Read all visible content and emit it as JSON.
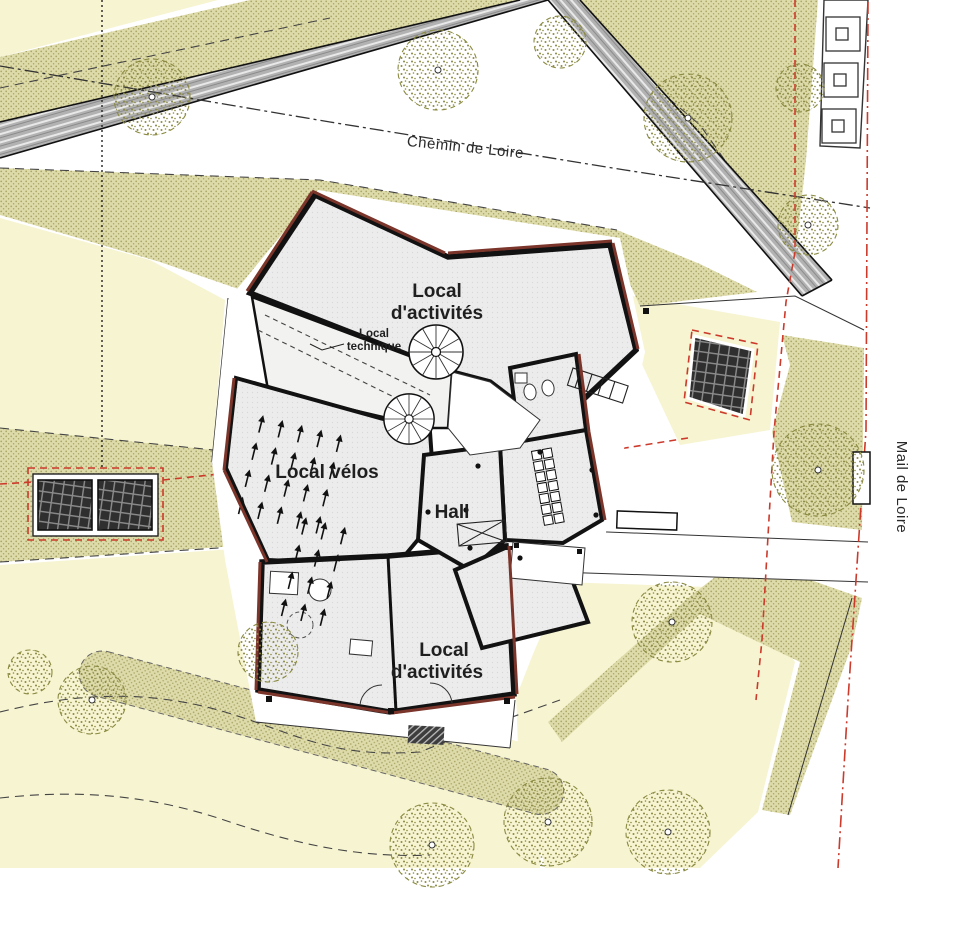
{
  "streets": {
    "top": "Chemin de Loire",
    "right": "Mail de Loire"
  },
  "rooms": {
    "activites_nord": {
      "line1": "Local",
      "line2": "d'activités"
    },
    "technique": {
      "line1": "Local",
      "line2": "technique"
    },
    "velos": {
      "label": "Local vélos"
    },
    "hall": {
      "label": "Hall"
    },
    "activites_sud": {
      "line1": "Local",
      "line2": "d'activités"
    }
  },
  "colors": {
    "area_yellow": "#f7f4d1",
    "area_green": "#dedbaa",
    "green_dot": "#a9a566",
    "road_gray": "#b2b2b2",
    "red_boundary": "#cc3a2c",
    "wall_black": "#121212",
    "wall_accent": "#7b352a",
    "room_fill": "#ececec",
    "tree_olive": "#8a8a42",
    "text_dark": "#1f1f1f"
  }
}
